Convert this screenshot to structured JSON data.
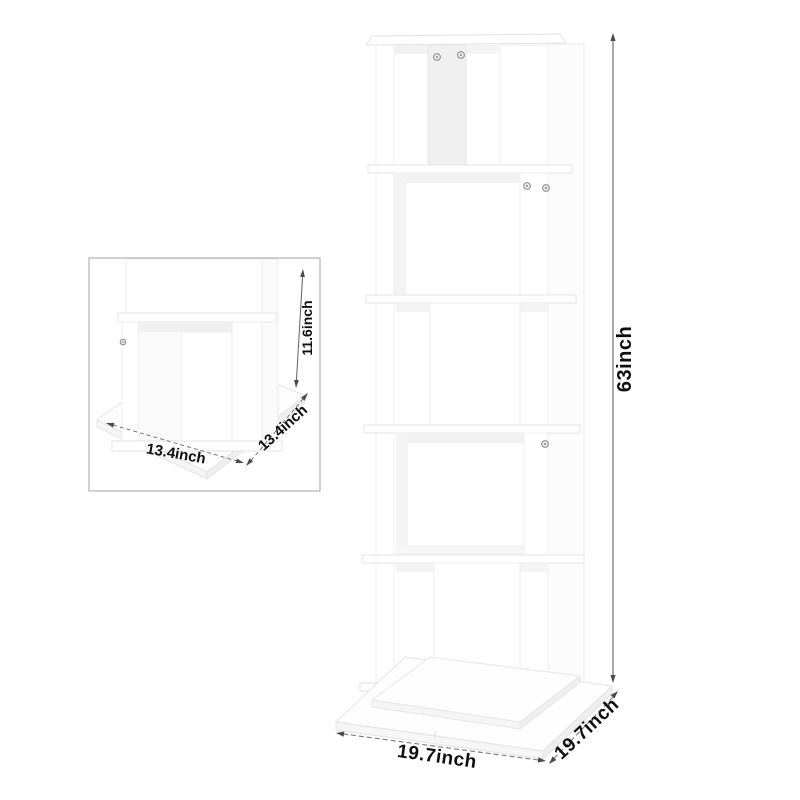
{
  "diagram": {
    "main": {
      "height_label": "63inch",
      "base_width_label": "19.7inch",
      "base_depth_label": "19.7inch"
    },
    "inset": {
      "tier_height_label": "11.6inch",
      "cube_width_label": "13.4inch",
      "cube_depth_label": "13.4inch"
    },
    "colors": {
      "background": "#ffffff",
      "annotation_text": "#0f0f0f",
      "dimension_line": "#606060",
      "dashed_dimension_line": "#787878",
      "arrowhead": "#4a4a4a",
      "inset_border": "#a3a3a3",
      "product_surface": "#ffffff",
      "product_edge": "#e6e6e6",
      "product_shade": "#f2f2f2",
      "screw": "#8d8d8d"
    }
  }
}
